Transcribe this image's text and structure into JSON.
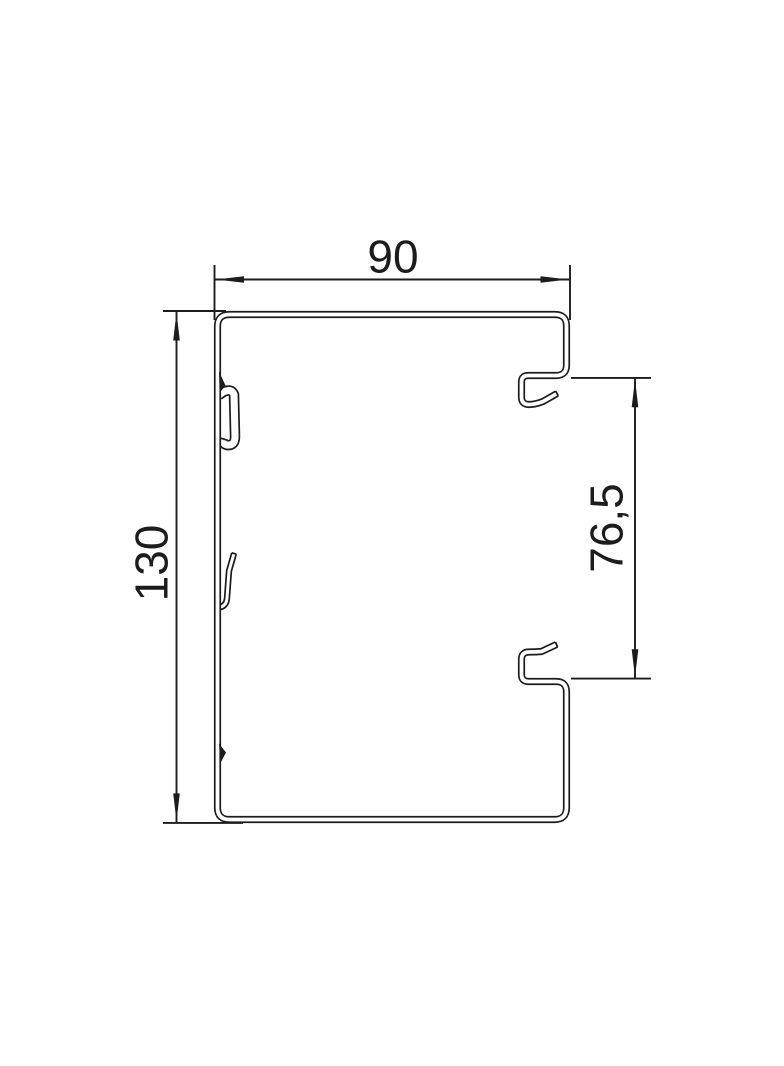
{
  "colors": {
    "line": "#1c1c1c",
    "background": "#ffffff"
  },
  "dimensions": {
    "width": {
      "label": "90"
    },
    "height": {
      "label": "130"
    },
    "opening": {
      "label": "76,5"
    }
  }
}
